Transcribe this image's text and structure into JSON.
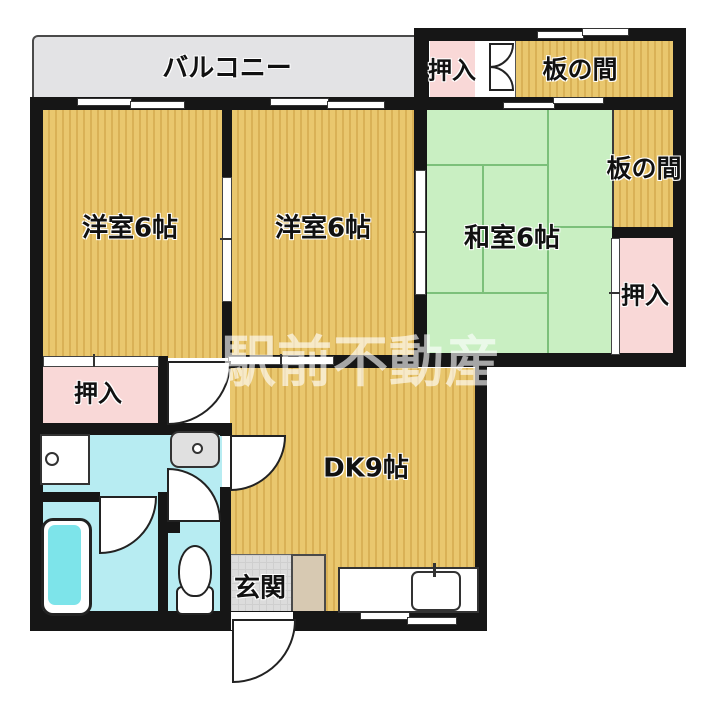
{
  "labels": {
    "balcony": "バルコニー",
    "western_room_1": "洋室6帖",
    "western_room_2": "洋室6帖",
    "japanese_room": "和室6帖",
    "dining_kitchen": "DK9帖",
    "entrance": "玄関",
    "wood_floor_top": "板の間",
    "wood_floor_right": "板の間",
    "closet_top": "押入",
    "closet_right": "押入",
    "closet_left": "押入"
  },
  "watermark": "駅前不動産",
  "colors": {
    "wood_floor": "#e9c76e",
    "wood_stripe": "#d9b156",
    "tatami_green": "#c9efc2",
    "tatami_line": "#7cc07a",
    "closet_pink": "#f9d8d7",
    "bath_cyan": "#b7ecf2",
    "bathtub_cyan": "#7de4ea",
    "balcony_gray": "#e3e3e5",
    "wall_black": "#161616",
    "entrance_gray": "#dcdcdc",
    "shoe_cabinet_tan": "#d7c9b2",
    "watermark_white": "rgba(255,255,255,0.62)"
  }
}
